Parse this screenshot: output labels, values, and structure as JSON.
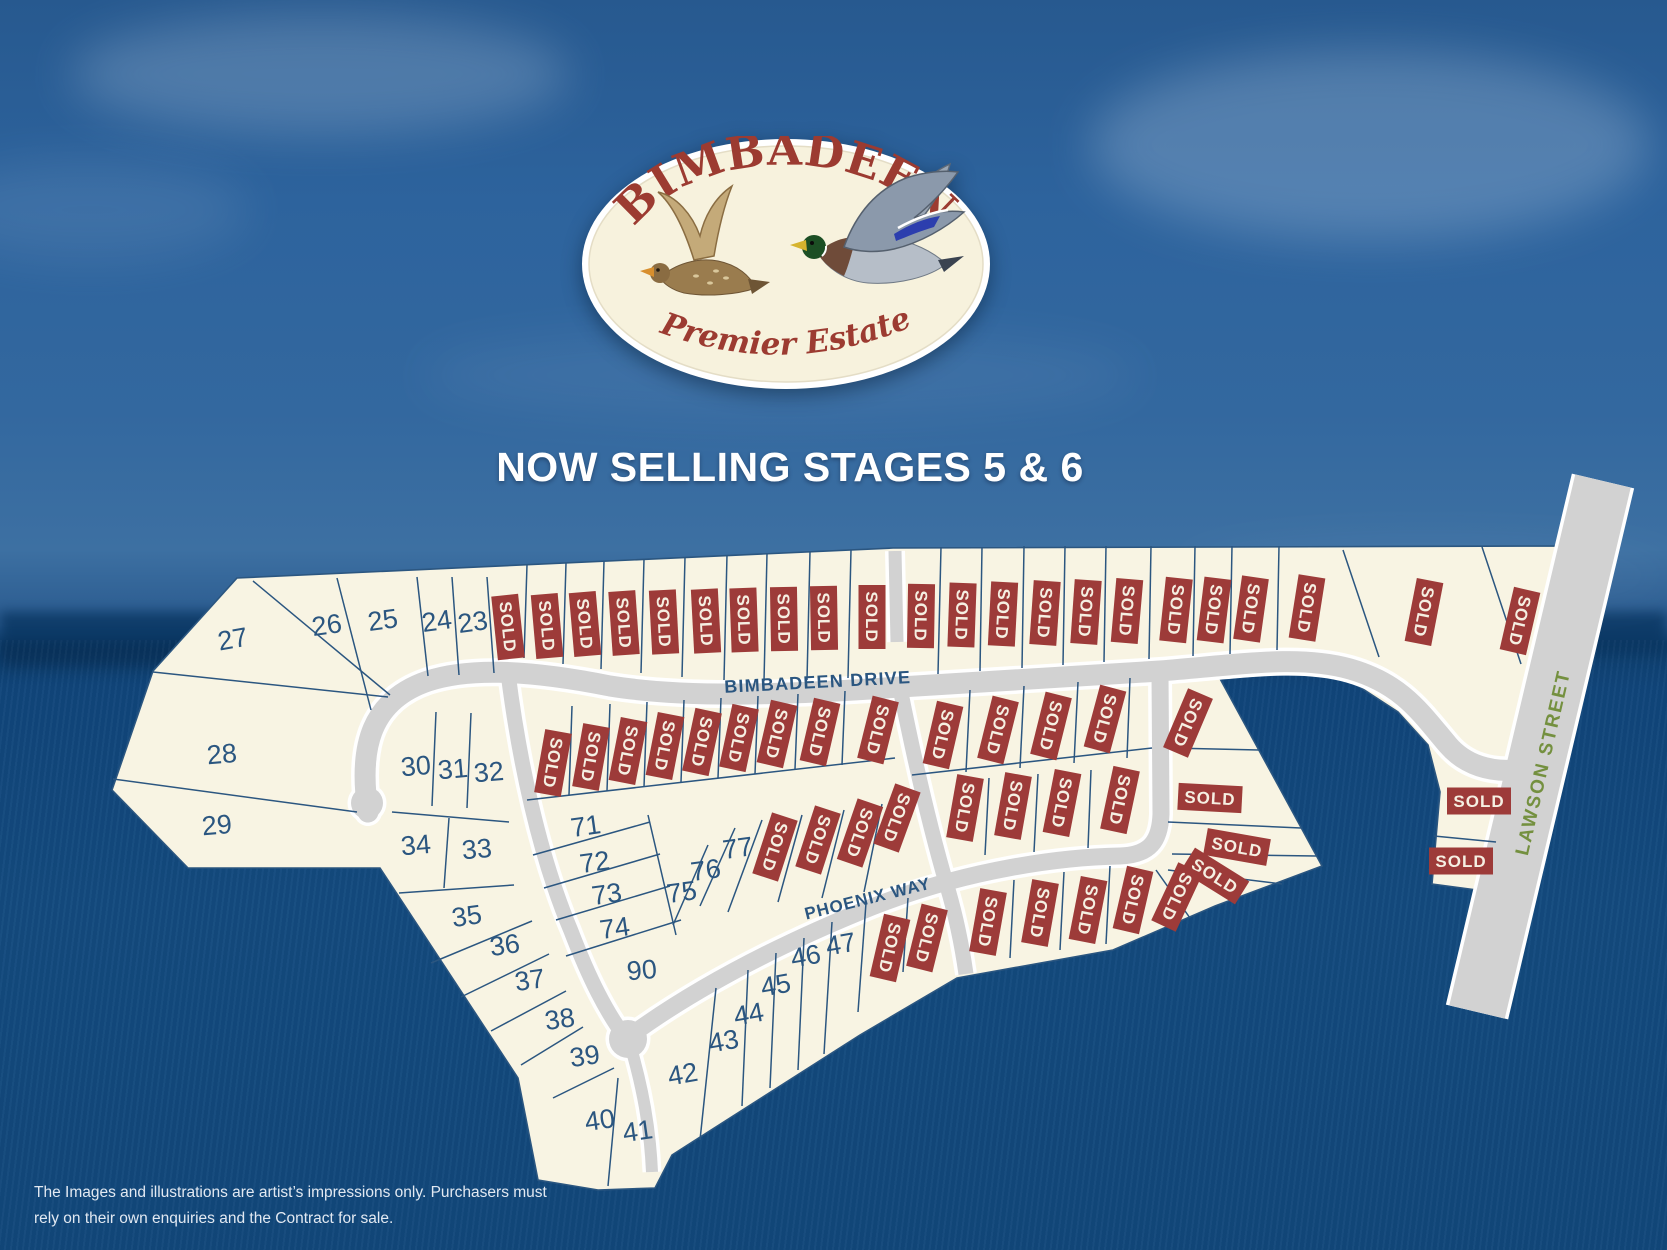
{
  "logo": {
    "name": "BIMBADEEN",
    "tagline": "Premier Estate"
  },
  "headline": "NOW SELLING STAGES 5 & 6",
  "disclaimer": {
    "line1": "The Images and illustrations are artist’s impressions only. Purchasers must",
    "line2": "rely on their own enquiries and the Contract for sale."
  },
  "sold_label": "SOLD",
  "colors": {
    "sky": "#2d639d",
    "field": "#134a7e",
    "lot_fill": "#f8f4e3",
    "lot_stroke": "#2b5680",
    "road_fill": "#d2d2d2",
    "road_casing": "#ffffff",
    "sold_bg": "#9d3b39",
    "sold_text": "#f5efe2",
    "number_color": "#2b5680",
    "label_blue": "#2b5680",
    "label_green": "#74903f",
    "logo_red": "#9c3b31",
    "logo_bg": "#f7f2dd",
    "headline_color": "#ffffff",
    "disclaimer_color": "#e2e9f2"
  },
  "map": {
    "road_labels": [
      {
        "id": "bimbadeen-drive",
        "text": "BIMBADEEN DRIVE",
        "x": 818,
        "y": 688,
        "rotate": -3,
        "size": 18,
        "ls": 1.2,
        "color_key": "label_blue"
      },
      {
        "id": "phoenix-way",
        "text": "PHOENIX WAY",
        "x": 869,
        "y": 904,
        "rotate": -14,
        "size": 17,
        "ls": 1,
        "color_key": "label_blue"
      },
      {
        "id": "lawson-street",
        "text": "LAWSON STREET",
        "x": 1549,
        "y": 764,
        "rotate": -77,
        "size": 19,
        "ls": 2,
        "color_key": "label_green"
      }
    ],
    "numbered_lots": [
      {
        "n": "27",
        "x": 233,
        "y": 641,
        "r": -10
      },
      {
        "n": "26",
        "x": 327,
        "y": 627,
        "r": -8
      },
      {
        "n": "25",
        "x": 383,
        "y": 622,
        "r": -8
      },
      {
        "n": "24",
        "x": 437,
        "y": 623,
        "r": -8
      },
      {
        "n": "23",
        "x": 473,
        "y": 624,
        "r": -8
      },
      {
        "n": "28",
        "x": 222,
        "y": 756,
        "r": -5
      },
      {
        "n": "29",
        "x": 217,
        "y": 827,
        "r": -5
      },
      {
        "n": "30",
        "x": 416,
        "y": 768,
        "r": -5
      },
      {
        "n": "31",
        "x": 453,
        "y": 771,
        "r": -5
      },
      {
        "n": "32",
        "x": 489,
        "y": 774,
        "r": -5
      },
      {
        "n": "34",
        "x": 416,
        "y": 847,
        "r": -5
      },
      {
        "n": "33",
        "x": 477,
        "y": 851,
        "r": -5
      },
      {
        "n": "35",
        "x": 467,
        "y": 918,
        "r": -8
      },
      {
        "n": "36",
        "x": 505,
        "y": 947,
        "r": -8
      },
      {
        "n": "37",
        "x": 530,
        "y": 982,
        "r": -8
      },
      {
        "n": "38",
        "x": 560,
        "y": 1021,
        "r": -8
      },
      {
        "n": "39",
        "x": 585,
        "y": 1058,
        "r": -8
      },
      {
        "n": "40",
        "x": 600,
        "y": 1122,
        "r": -8
      },
      {
        "n": "41",
        "x": 638,
        "y": 1133,
        "r": -8
      },
      {
        "n": "42",
        "x": 683,
        "y": 1076,
        "r": -10
      },
      {
        "n": "43",
        "x": 724,
        "y": 1043,
        "r": -10
      },
      {
        "n": "44",
        "x": 749,
        "y": 1016,
        "r": -10
      },
      {
        "n": "45",
        "x": 776,
        "y": 987,
        "r": -10
      },
      {
        "n": "46",
        "x": 806,
        "y": 958,
        "r": -10
      },
      {
        "n": "47",
        "x": 841,
        "y": 946,
        "r": -10
      },
      {
        "n": "71",
        "x": 586,
        "y": 828,
        "r": -8
      },
      {
        "n": "72",
        "x": 595,
        "y": 864,
        "r": -8
      },
      {
        "n": "73",
        "x": 607,
        "y": 896,
        "r": -8
      },
      {
        "n": "74",
        "x": 615,
        "y": 930,
        "r": -8
      },
      {
        "n": "90",
        "x": 642,
        "y": 972,
        "r": -5
      },
      {
        "n": "75",
        "x": 682,
        "y": 894,
        "r": -8
      },
      {
        "n": "76",
        "x": 706,
        "y": 872,
        "r": -8
      },
      {
        "n": "77",
        "x": 738,
        "y": 850,
        "r": -8
      }
    ],
    "sold_markers": [
      [
        508,
        627,
        84
      ],
      [
        547,
        626,
        85
      ],
      [
        585,
        624,
        85
      ],
      [
        624,
        623,
        86
      ],
      [
        664,
        622,
        87
      ],
      [
        706,
        621,
        87
      ],
      [
        744,
        620,
        88
      ],
      [
        784,
        619,
        89
      ],
      [
        824,
        618,
        89
      ],
      [
        872,
        617,
        90
      ],
      [
        921,
        616,
        91
      ],
      [
        962,
        615,
        92
      ],
      [
        1003,
        614,
        93
      ],
      [
        1045,
        613,
        94
      ],
      [
        1086,
        612,
        94
      ],
      [
        1127,
        611,
        95
      ],
      [
        1176,
        610,
        96
      ],
      [
        1214,
        610,
        97
      ],
      [
        1251,
        609,
        98
      ],
      [
        1307,
        608,
        99
      ],
      [
        1424,
        612,
        101
      ],
      [
        1520,
        621,
        103
      ],
      [
        553,
        763,
        100
      ],
      [
        591,
        757,
        100
      ],
      [
        628,
        751,
        101
      ],
      [
        665,
        746,
        101
      ],
      [
        702,
        742,
        102
      ],
      [
        739,
        738,
        102
      ],
      [
        777,
        734,
        103
      ],
      [
        820,
        732,
        103
      ],
      [
        878,
        730,
        104
      ],
      [
        775,
        847,
        108
      ],
      [
        818,
        840,
        108
      ],
      [
        860,
        833,
        109
      ],
      [
        897,
        818,
        110
      ],
      [
        943,
        735,
        103
      ],
      [
        998,
        730,
        104
      ],
      [
        1051,
        726,
        104
      ],
      [
        1105,
        719,
        105
      ],
      [
        965,
        808,
        100
      ],
      [
        1013,
        806,
        100
      ],
      [
        1062,
        803,
        101
      ],
      [
        1120,
        800,
        102
      ],
      [
        1188,
        723,
        113
      ],
      [
        1210,
        798,
        3
      ],
      [
        1237,
        847,
        10
      ],
      [
        1215,
        876,
        32
      ],
      [
        890,
        948,
        103
      ],
      [
        927,
        938,
        104
      ],
      [
        988,
        922,
        100
      ],
      [
        1040,
        913,
        100
      ],
      [
        1088,
        910,
        101
      ],
      [
        1133,
        900,
        103
      ],
      [
        1177,
        897,
        115
      ],
      [
        1479,
        801,
        0
      ],
      [
        1461,
        861,
        0
      ]
    ]
  }
}
